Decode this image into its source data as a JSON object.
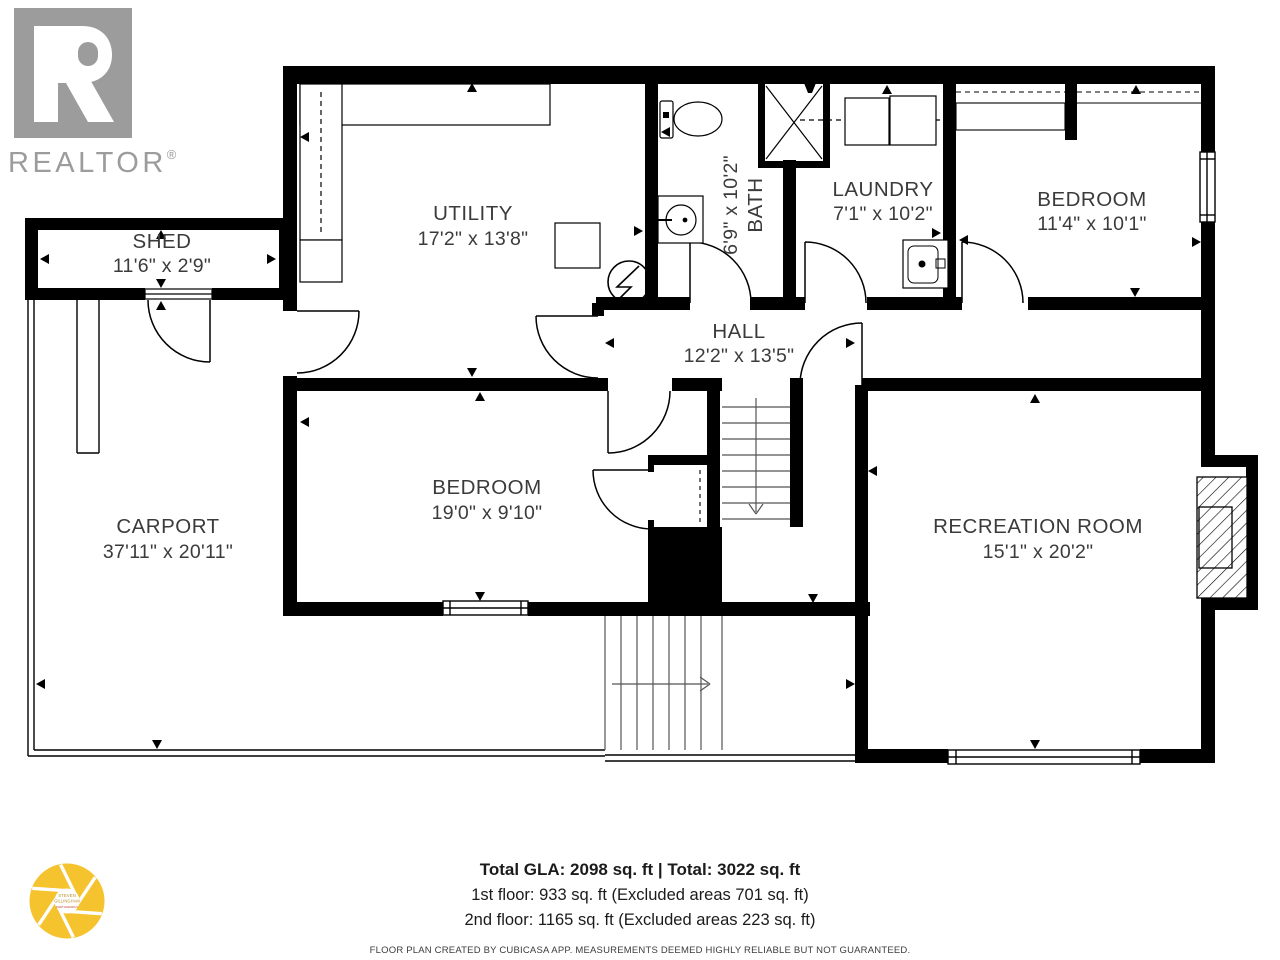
{
  "plan": {
    "rooms": [
      {
        "id": "shed",
        "name": "SHED",
        "dims": "11'6\" x 2'9\""
      },
      {
        "id": "utility",
        "name": "UTILITY",
        "dims": "17'2\" x 13'8\""
      },
      {
        "id": "bath",
        "name": "BATH",
        "dims": "6'9\" x 10'2\""
      },
      {
        "id": "laundry",
        "name": "LAUNDRY",
        "dims": "7'1\" x 10'2\""
      },
      {
        "id": "bedroom-upper",
        "name": "BEDROOM",
        "dims": "11'4\" x 10'1\""
      },
      {
        "id": "hall",
        "name": "HALL",
        "dims": "12'2\" x 13'5\""
      },
      {
        "id": "bedroom-main",
        "name": "BEDROOM",
        "dims": "19'0\" x 9'10\""
      },
      {
        "id": "carport",
        "name": "CARPORT",
        "dims": "37'11\" x 20'11\""
      },
      {
        "id": "recreation-room",
        "name": "RECREATION ROOM",
        "dims": "15'1\" x 20'2\""
      }
    ],
    "icons": [
      "toilet-icon",
      "shower-icon",
      "shower-head-icon",
      "sink-icon",
      "laundry-sink-icon",
      "washer-icon",
      "dryer-icon",
      "electrical-panel-icon",
      "fireplace-icon",
      "stairs-down-arrow",
      "stairs-right-arrow"
    ]
  },
  "branding": {
    "realtor_wordmark": "REALTOR",
    "registered_mark": "®",
    "photographer": {
      "line1": "STEVEN",
      "line2": "GILLINGHAM",
      "line3": "PHOTOGRAPHY"
    }
  },
  "summary": {
    "total_line": "Total GLA: 2098 sq. ft | Total: 3022 sq. ft",
    "first_floor": "1st floor: 933 sq. ft (Excluded areas 701 sq. ft)",
    "second_floor": "2nd floor: 1165 sq. ft (Excluded areas 223 sq. ft)",
    "disclaimer": "FLOOR PLAN CREATED BY CUBICASA APP. MEASUREMENTS DEEMED HIGHLY RELIABLE BUT NOT GUARANTEED."
  },
  "colors": {
    "wall": "#000000",
    "realtor_gray": "#9c9c9c",
    "aperture_yellow": "#f5c32e",
    "aperture_text": "#b8922a",
    "label_text": "#3b3b3b"
  }
}
